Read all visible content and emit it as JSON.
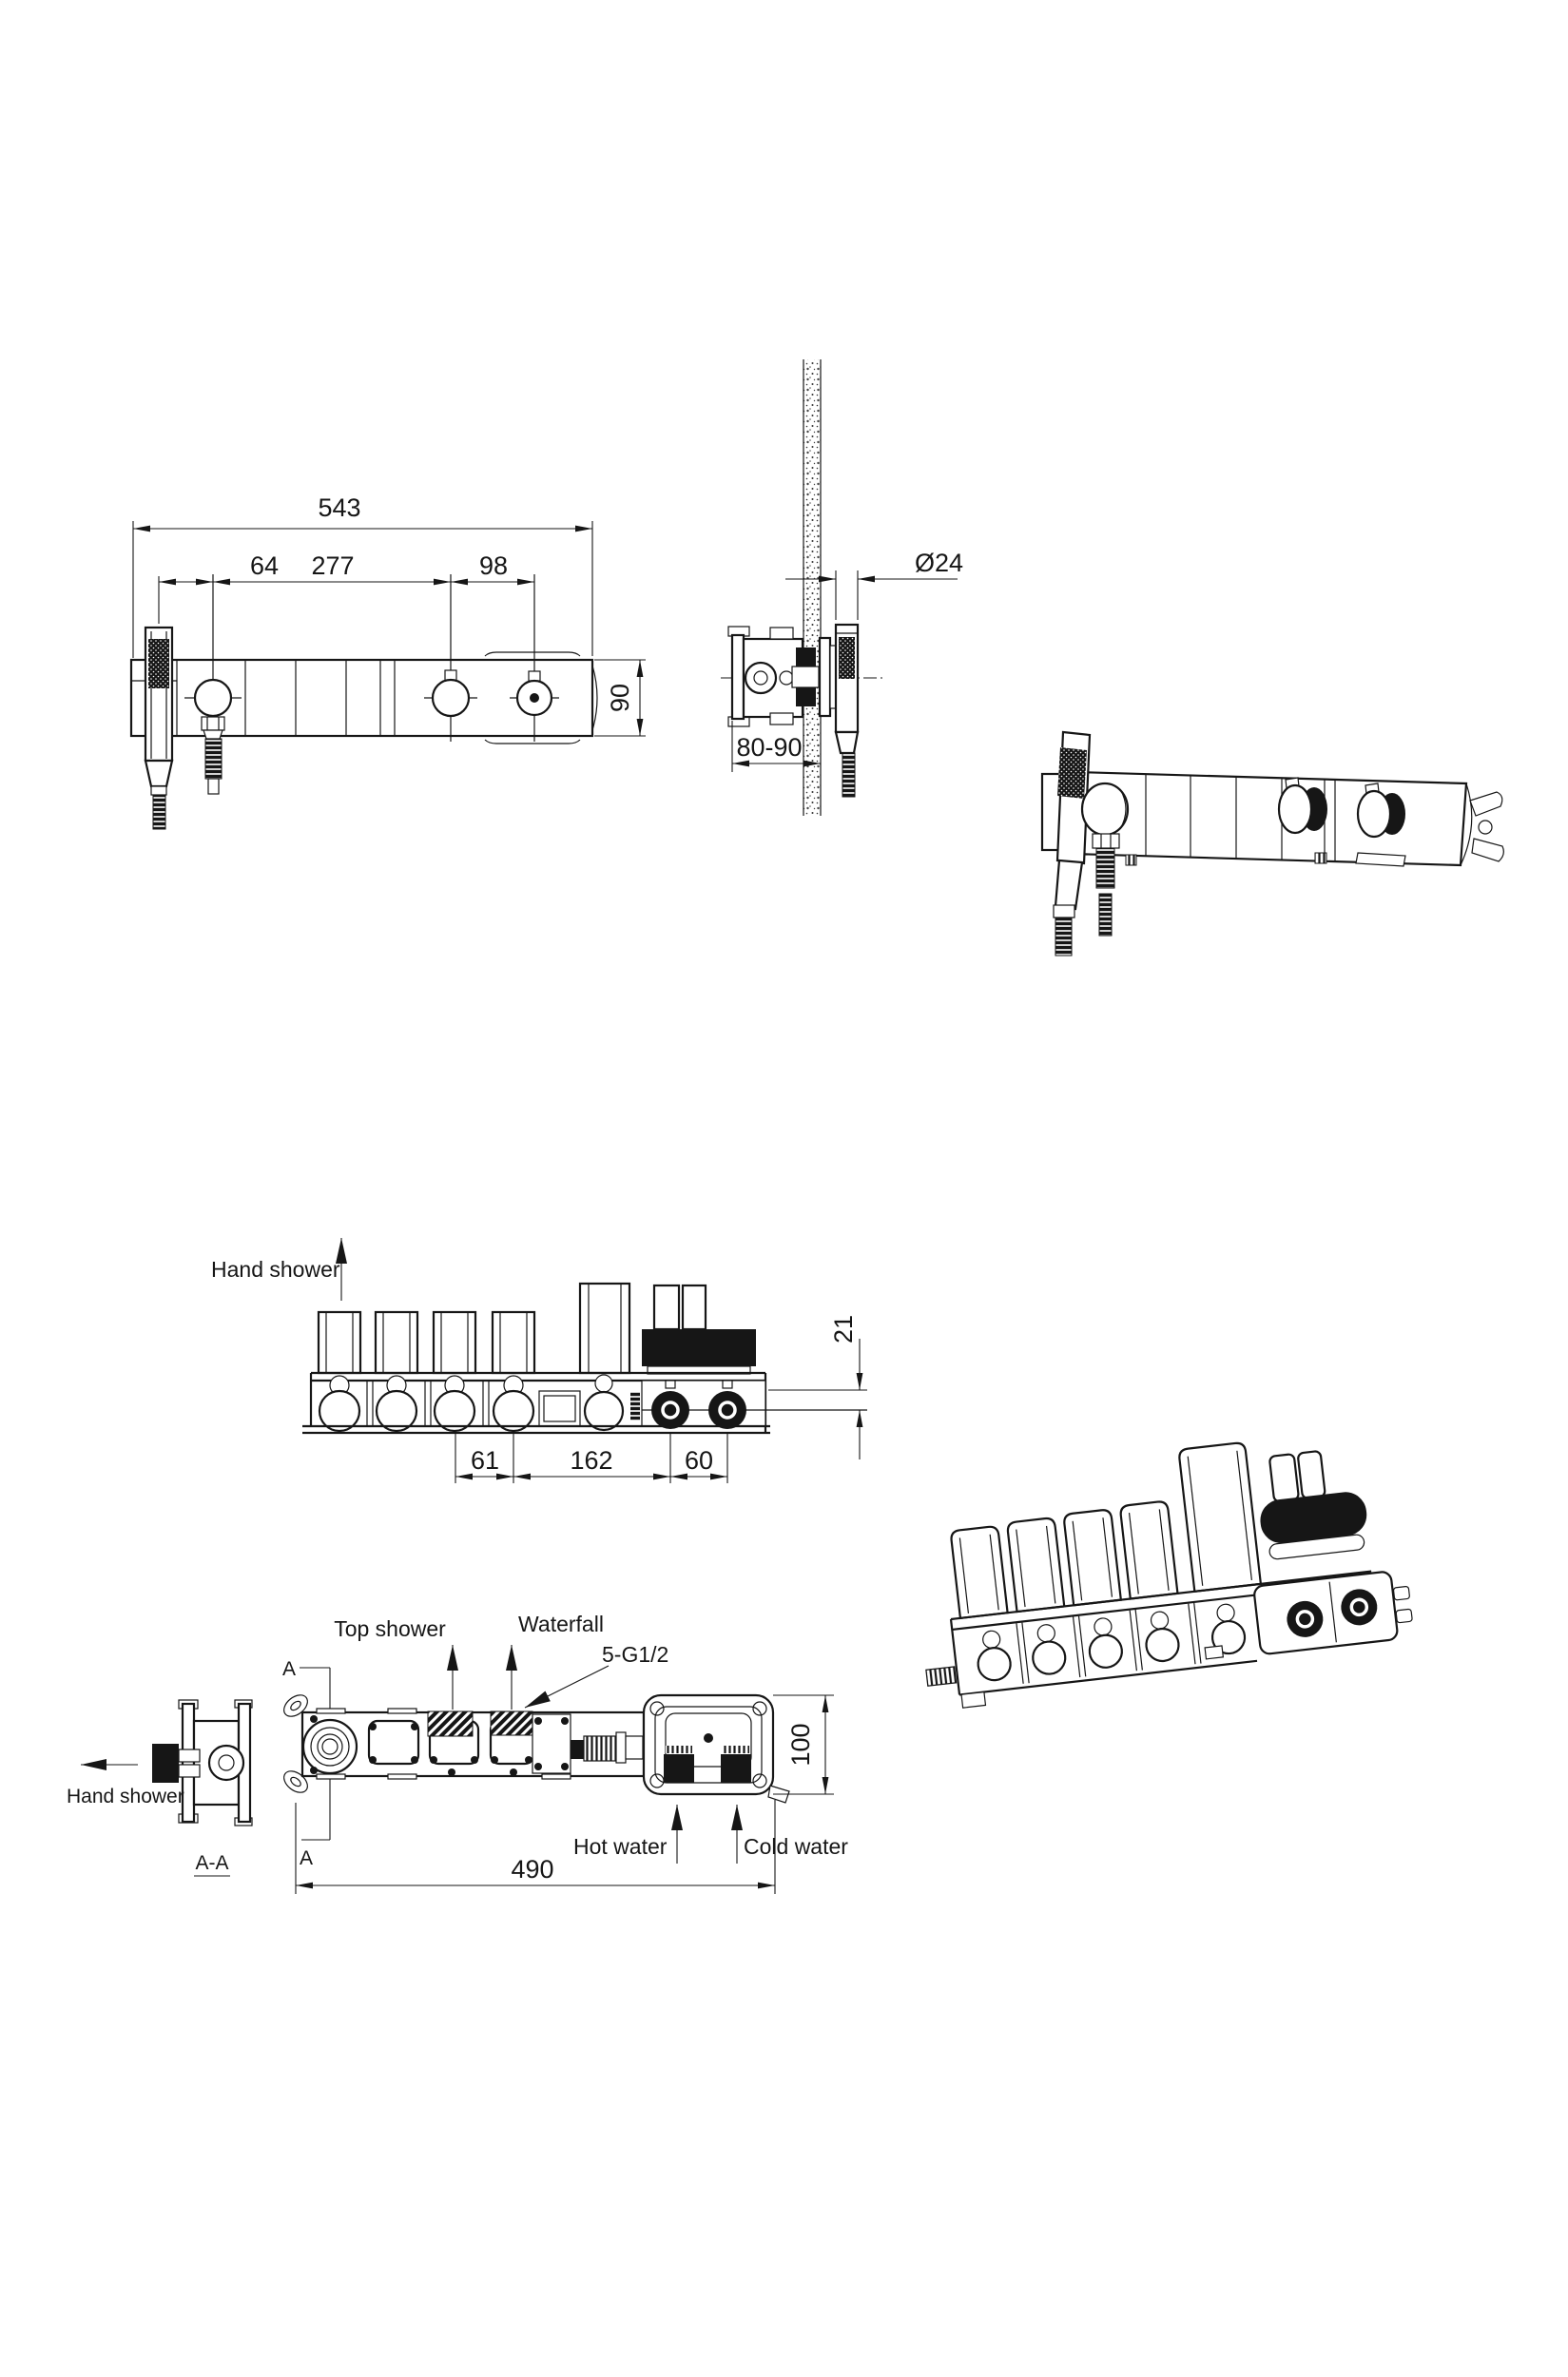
{
  "page": {
    "background": "#ffffff",
    "line_color": "#161616"
  },
  "front_view": {
    "dim_total_width": "543",
    "dim_hand_shower_offset": "64",
    "dim_knob_span": "277",
    "dim_right_knob_span": "98",
    "dim_bar_height": "90"
  },
  "side_view": {
    "dim_hose_diameter": "Ø24",
    "dim_mounting_depth": "80-90"
  },
  "rough_in_front_view": {
    "label_hand_shower": "Hand shower",
    "dim_chamber_pitch": "61",
    "dim_valve_span": "162",
    "dim_knob_pitch": "60",
    "dim_plate_offset": "21"
  },
  "rough_in_top_view": {
    "label_top_shower": "Top shower",
    "label_waterfall": "Waterfall",
    "label_thread_spec": "5-G1/2",
    "label_hot_water": "Hot water",
    "label_cold_water": "Cold water",
    "label_hand_shower": "Hand  shower",
    "label_section": "A-A",
    "label_section_marker_top": "A",
    "label_section_marker_bottom": "A",
    "dim_body_length": "490",
    "dim_body_width": "100"
  }
}
